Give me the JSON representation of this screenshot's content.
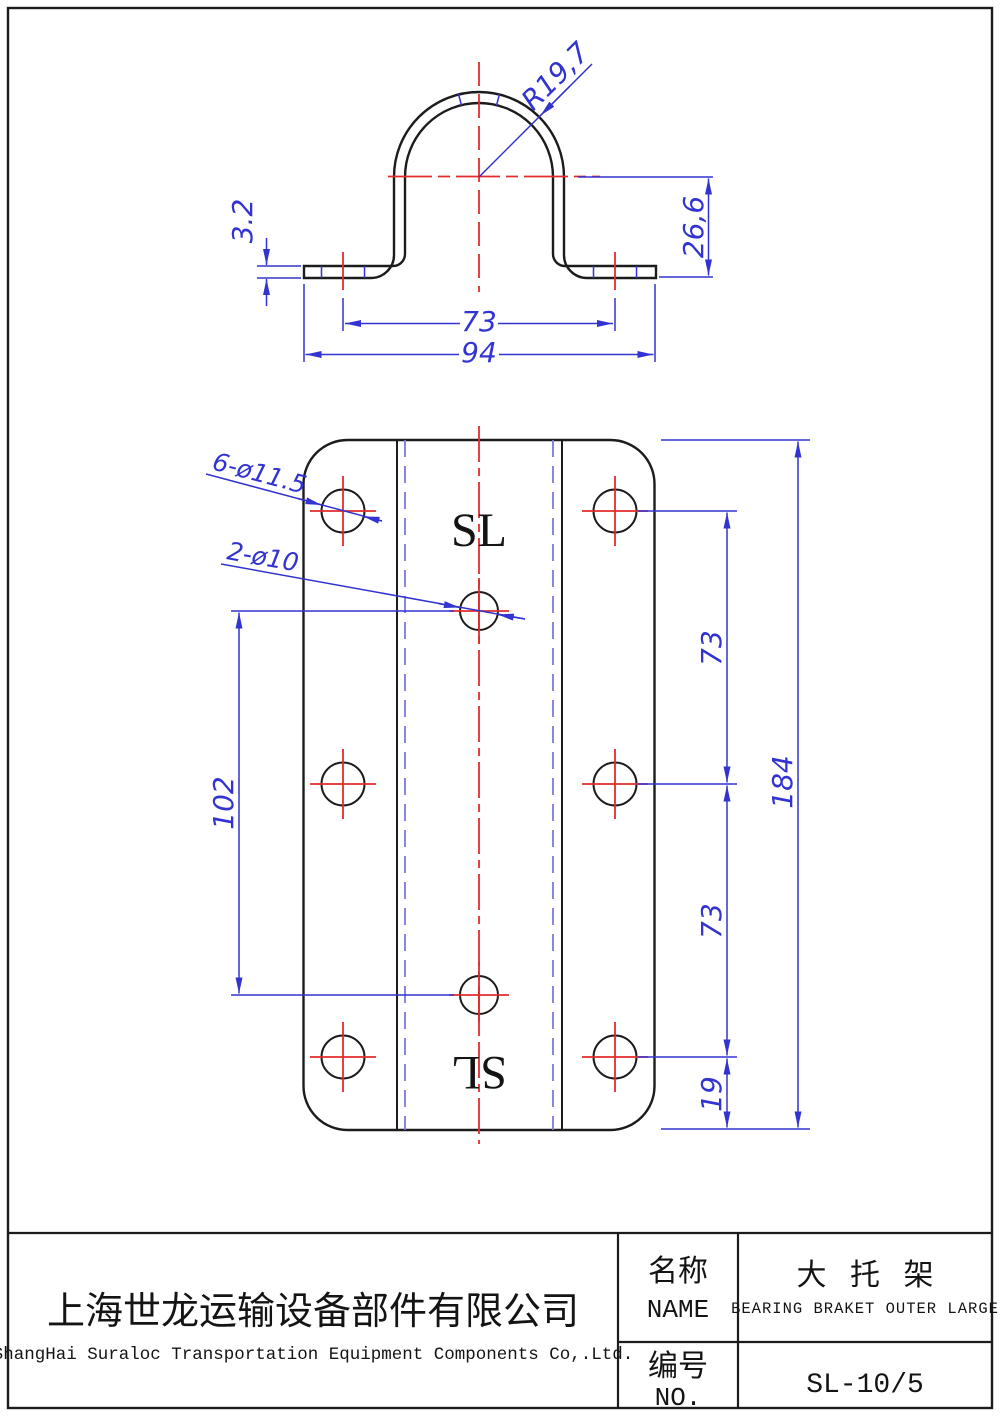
{
  "profile_view": {
    "radius": "R19,7",
    "thickness": "3.2",
    "height": "26,6",
    "hole_spacing": "73",
    "overall_width": "94"
  },
  "plan_view": {
    "large_holes_label": "6-ø11.5",
    "small_holes_label": "2-ø10",
    "small_hole_spacing": "102",
    "upper_row_spacing": "73",
    "lower_row_spacing": "73",
    "bottom_edge_offset": "19",
    "overall_length": "184",
    "brand_mark_top": "SL",
    "brand_mark_bottom": "SL"
  },
  "title_block": {
    "company_cn": "上海世龙运输设备部件有限公司",
    "company_en": "ShangHai Suraloc Transportation Equipment Components Co,.Ltd.",
    "name_label_cn": "名称",
    "name_label_en": "NAME",
    "part_name_cn": "大 托 架",
    "part_name_en": "BEARING BRAKET OUTER LARGE",
    "no_label_cn": "编号",
    "no_label_en": "NO.",
    "part_no": "SL-10/5"
  },
  "colors": {
    "geometry": "#1c1c1c",
    "dimension_blue": "#3333d1",
    "centerline_red": "#e32b2b",
    "bendline_blue": "#7a7ae0",
    "background": "#ffffff"
  }
}
